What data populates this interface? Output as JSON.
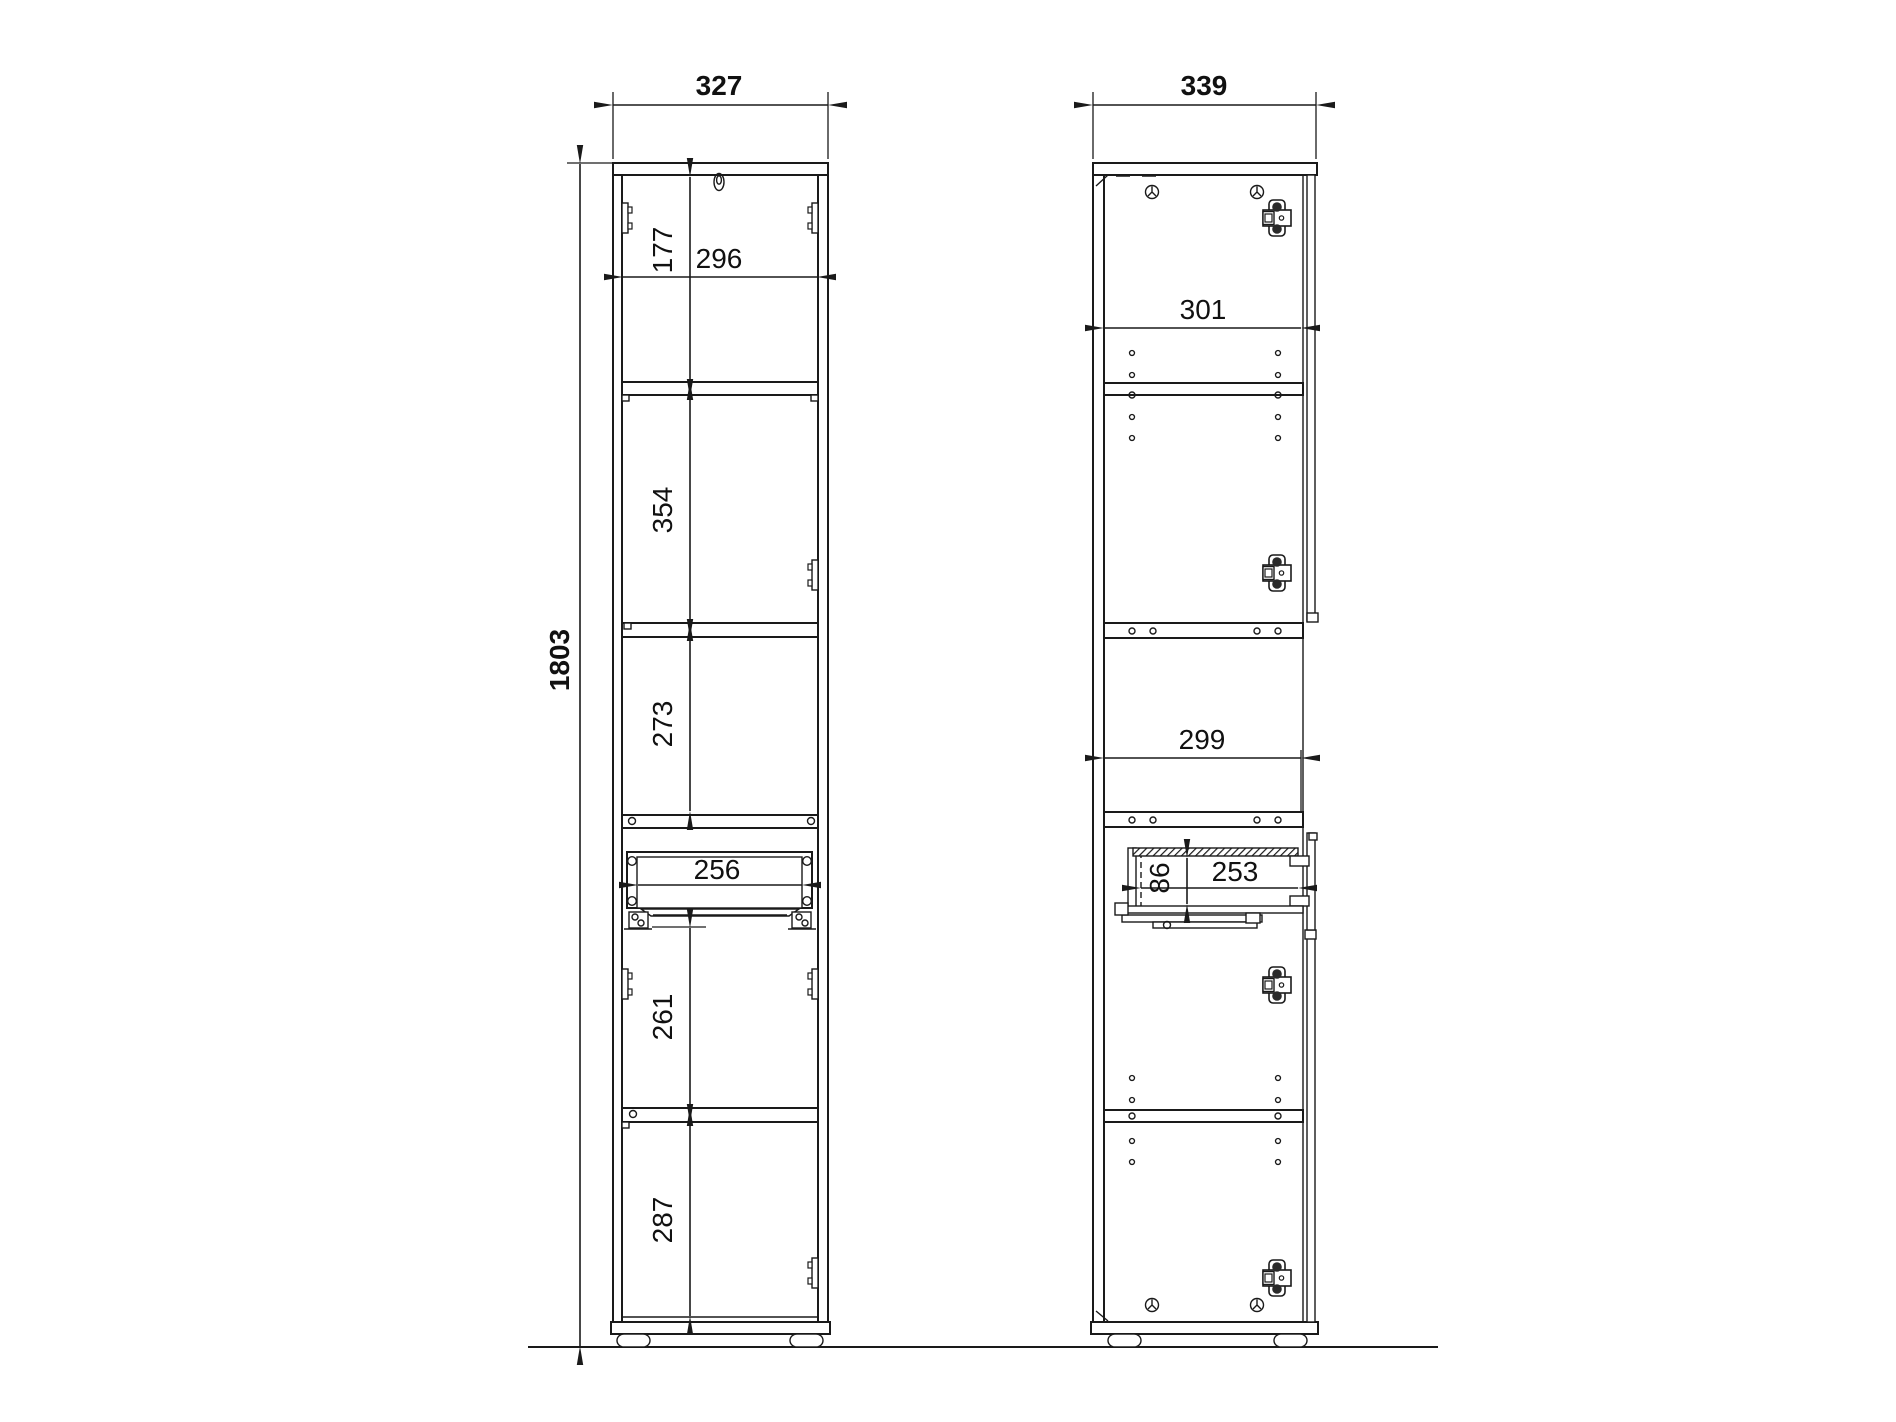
{
  "colors": {
    "line": "#1a1a1a",
    "text": "#111111",
    "background": "#ffffff"
  },
  "dims": {
    "front_width": "327",
    "side_width": "339",
    "height_total": "1803",
    "front_inner_width": "296",
    "front_top_section": "177",
    "front_section_2": "354",
    "front_section_3": "273",
    "front_drawer_inner_width": "256",
    "front_section_4": "261",
    "front_bottom_section": "287",
    "side_inner_width_top": "301",
    "side_inner_width_middle": "299",
    "side_drawer_inner_depth": "253",
    "side_drawer_inner_height": "86"
  }
}
